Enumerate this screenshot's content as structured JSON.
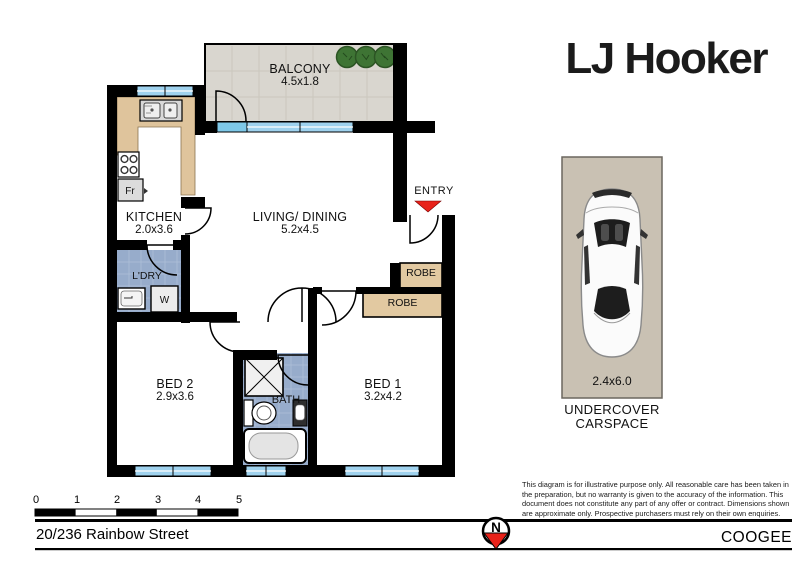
{
  "brand": {
    "logo": "LJ Hooker"
  },
  "floorplan": {
    "rooms": {
      "balcony": {
        "name": "BALCONY",
        "dims": "4.5x1.8"
      },
      "kitchen": {
        "name": "KITCHEN",
        "dims": "2.0x3.6"
      },
      "living": {
        "name": "LIVING/ DINING",
        "dims": "5.2x4.5"
      },
      "laundry": {
        "name": "L'DRY"
      },
      "bed2": {
        "name": "BED 2",
        "dims": "2.9x3.6"
      },
      "bed1": {
        "name": "BED 1",
        "dims": "3.2x4.2"
      },
      "bath": {
        "name": "BATH"
      }
    },
    "entry_label": "ENTRY",
    "robes": {
      "robe1": "ROBE",
      "robe2": "ROBE"
    },
    "fixtures": {
      "fridge": "Fr",
      "washer": "W"
    }
  },
  "carspace": {
    "dims": "2.4x6.0",
    "line1": "UNDERCOVER",
    "line2": "CARSPACE"
  },
  "scale_bar": {
    "ticks": [
      "0",
      "1",
      "2",
      "3",
      "4",
      "5"
    ]
  },
  "footer": {
    "address": "20/236 Rainbow Street",
    "suburb": "COOGEE",
    "north_label": "N"
  },
  "disclaimer": "This diagram is for illustrative purpose only. All reasonable care has been taken in the preparation, but no warranty is given to the accuracy of the information. This document does not constitute any part of any offer or contract. Dimensions shown are approximate only. Prospective purchasers must rely on their own enquiries.",
  "colors": {
    "wall": "#000000",
    "bench": "#dfc49c",
    "robe": "#e2c9a1",
    "tile": "#97accb",
    "tile_line": "#aebfd8",
    "balcony_floor": "#d9d6cf",
    "balcony_line": "#cbc7be",
    "window": "#9fd2ee",
    "window_bright": "#7ec8e8",
    "entry_red": "#e8221a",
    "carspace_bg": "#c9c1b3",
    "plant_green": "#3e7434"
  }
}
